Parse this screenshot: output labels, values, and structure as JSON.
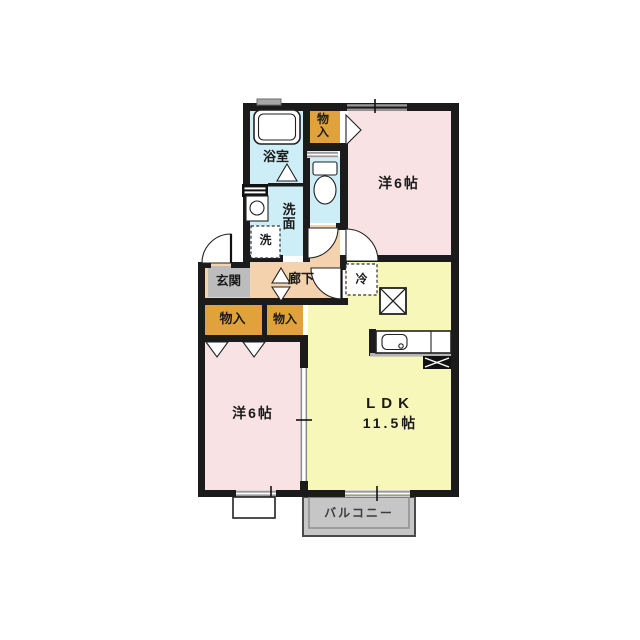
{
  "floorplan": {
    "labels": {
      "bath": "浴室",
      "storage_top": "物入",
      "bedroom_ne": "洋6帖",
      "washroom": "洗面",
      "washer": "洗",
      "genkan": "玄関",
      "hallway": "廊下",
      "fridge": "冷",
      "storage_left": "物入",
      "storage_right": "物入",
      "bedroom_sw": "洋6帖",
      "ldk_line1": "LDK",
      "ldk_line2": "11.5帖",
      "balcony": "バルコニー"
    },
    "colors": {
      "wall": "#1b1b1b",
      "water_blue": "#cdeef6",
      "bedroom_pink": "#f9e2e4",
      "ldk_yellow": "#f8f7ba",
      "hallway_peach": "#f3d2ad",
      "storage_orange": "#e1a23b",
      "genkan_gray": "#bcbcbc",
      "balcony_gray": "#c6c6c6",
      "window_gray": "#9a9a9a"
    }
  }
}
